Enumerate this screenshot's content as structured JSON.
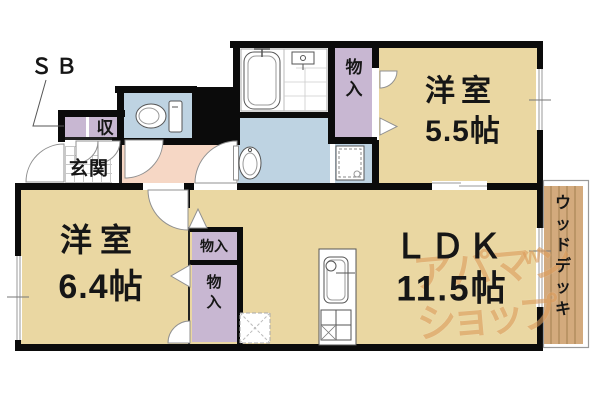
{
  "rooms": {
    "western_top": {
      "name": "洋室",
      "size": "5.5帖"
    },
    "western_left": {
      "name": "洋室",
      "size": "6.4帖"
    },
    "ldk": {
      "name": "ＬＤＫ",
      "size": "11.5帖"
    },
    "entrance": {
      "label": "玄関"
    },
    "storage_sb": {
      "label": "ＳＢ"
    },
    "storage_shu": {
      "label": "収"
    },
    "closet_top": {
      "label": "物入"
    },
    "closet_mid": {
      "label": "物入"
    },
    "closet_bottom": {
      "label": "物入"
    },
    "wood_deck": {
      "label": "ウッドデッキ"
    }
  },
  "watermark": {
    "line1": "アパマン",
    "line2": "ショップ",
    "mark": "w"
  },
  "colors": {
    "room_tan": "#ead7a2",
    "closet_purple": "#c8b7d2",
    "water_blue": "#bed3e2",
    "hall_pink": "#f6d7c5",
    "deck_wood": "#d3aa7d",
    "deck_line": "#ab8758",
    "wall_black": "#0b0b0b",
    "watermark_orange": "#dd9e5e"
  }
}
